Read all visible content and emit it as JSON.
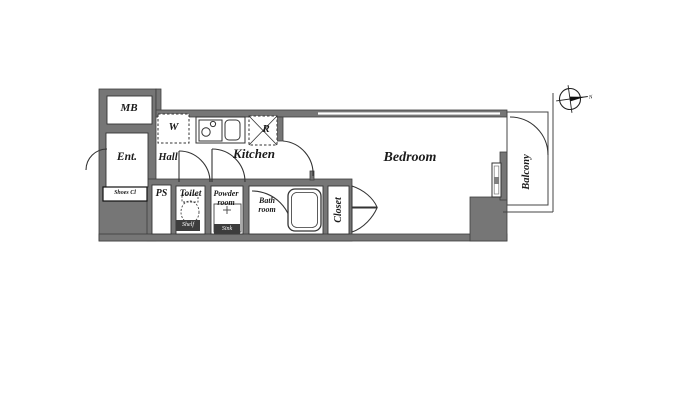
{
  "labels": {
    "meter_box": "MB",
    "entrance": "Ent.",
    "shoes_closet": "Shoes Cl",
    "hall": "Hall",
    "washer": "W",
    "kitchen": "Kitchen",
    "refrigerator": "R",
    "pipe_space": "PS",
    "toilet": "Toilet",
    "powder_room": "Powder room",
    "bath_room": "Bath room",
    "closet": "Closet",
    "bedroom": "Bedroom",
    "balcony": "Balcony"
  },
  "fixture_labels": {
    "toilet_shelf": "Shelf",
    "powder_sink": "Sink"
  },
  "compass": {
    "north": "N"
  },
  "colors": {
    "wall": "#767676",
    "wall_edge": "#3e3e3e",
    "line": "#333333",
    "background": "#ffffff",
    "text": "#1b1b1b",
    "fixture_tag_bg": "#3d3d3d",
    "fixture_tag_text": "#ffffff"
  }
}
